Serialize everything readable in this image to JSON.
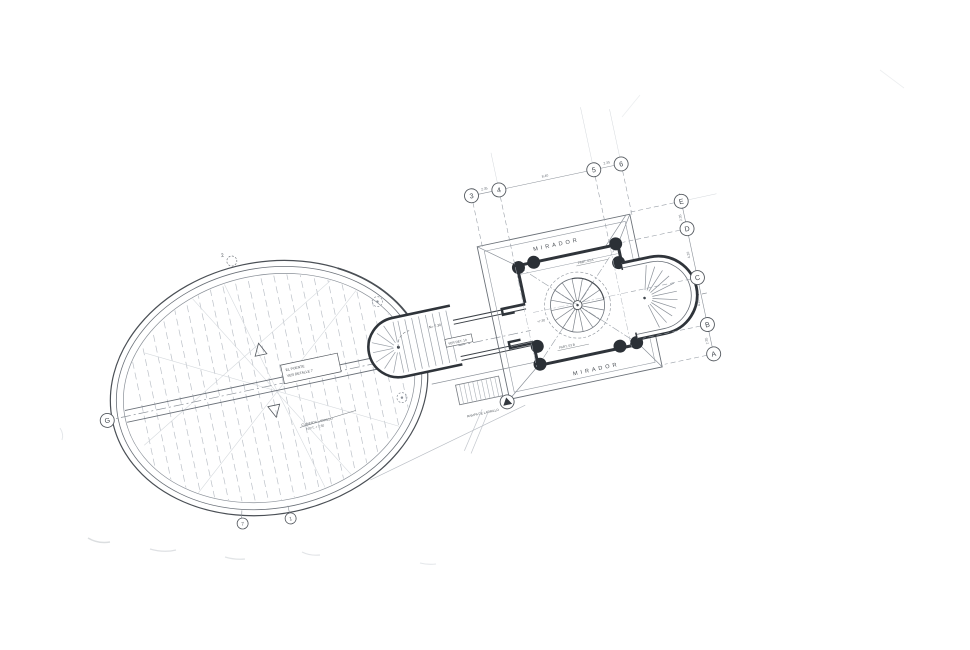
{
  "drawing": {
    "mirador_top": "MIRADOR",
    "mirador_bottom": "MIRADOR"
  },
  "grid": {
    "top": [
      "3",
      "4",
      "5",
      "6"
    ],
    "right": [
      "E",
      "D",
      "C",
      "B",
      "A"
    ],
    "left": "G",
    "ellipse_bottom": [
      "7",
      "1"
    ],
    "ellipse_top": "2"
  },
  "dimensions": {
    "top": [
      "2.35",
      "8.40",
      "2.35"
    ],
    "right": [
      "2.35",
      "4.20",
      "4.20",
      "2.35"
    ]
  },
  "annotations": {
    "level_stair": "N= 7.30",
    "detail_box": "VER DET. 10",
    "level_room": "+7.30",
    "part_a": "PART. 03 A",
    "part_b": "PART. 03 B",
    "ramp": "RAMPA DE LADRILLO",
    "beam_box_line1": "EL PUENTE",
    "beam_box_line2": "VER DETALLE 7",
    "roof_note_line1": "CUBIERTA LADRILLO",
    "roof_note_line2": "N.P.T. + 7.30"
  },
  "colors": {
    "ink": "#3f454c",
    "wall": "#2f343a",
    "light": "#9aa0a8",
    "faint": "#cdd1d6",
    "paper": "#ffffff"
  }
}
